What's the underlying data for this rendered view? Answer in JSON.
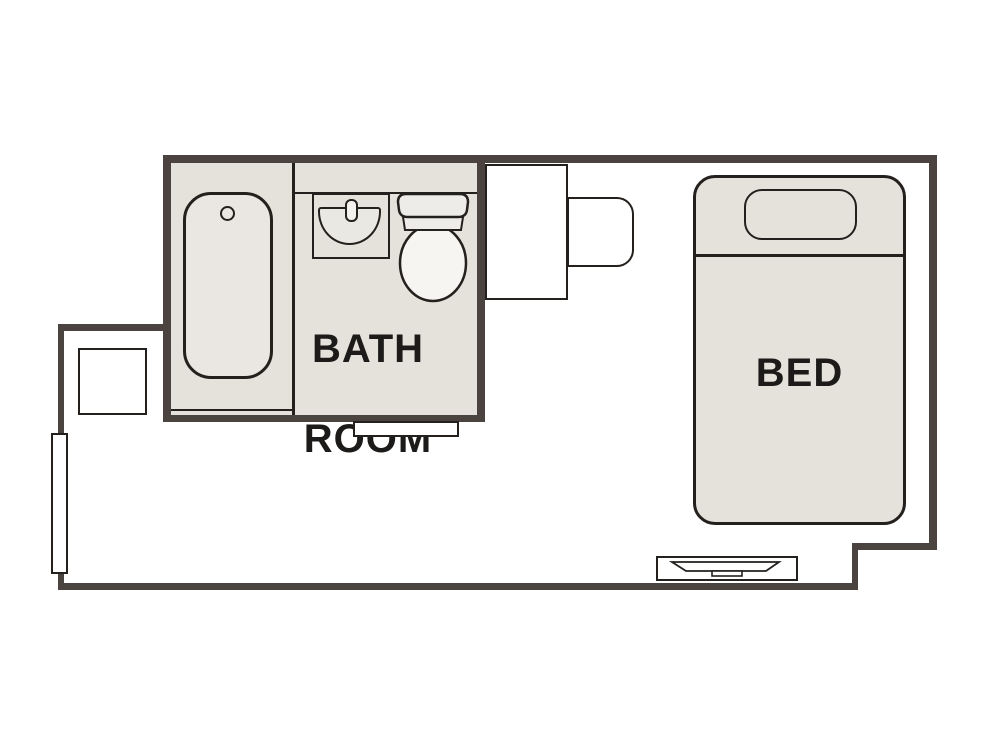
{
  "theme": {
    "bg": "#ffffff",
    "wall": "#4a4340",
    "roomfill": "#e5e2dc",
    "line": "#23201d",
    "text": "#1d1b19",
    "fixture_white": "#f6f5f2"
  },
  "plan": {
    "bathroom": {
      "label_line1": "BATH",
      "label_line2": "ROOM",
      "fixtures": [
        "bathtub",
        "bathtub-drain",
        "vanity-counter",
        "washbasin",
        "faucet",
        "toilet"
      ]
    },
    "bedroom": {
      "bed_label": "BED",
      "fixtures": [
        "bed",
        "pillow",
        "tv-board",
        "tv",
        "desk",
        "chair",
        "side-table",
        "window",
        "bathroom-sliding-door"
      ]
    }
  }
}
